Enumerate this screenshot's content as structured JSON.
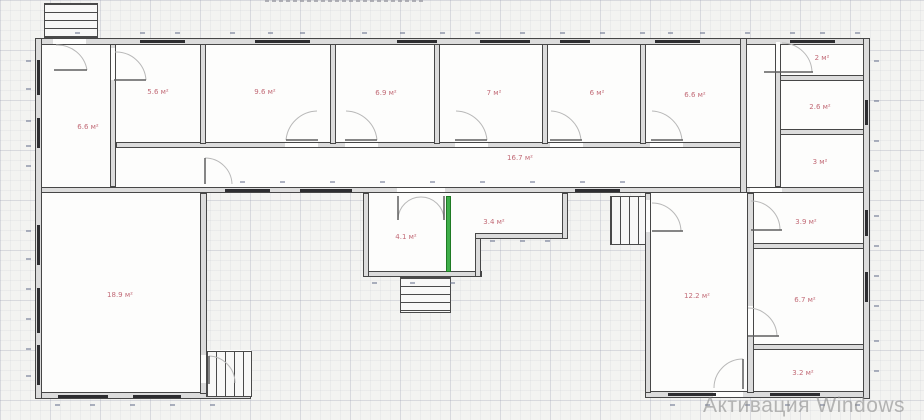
{
  "app": {
    "watermark": "Активация Windows"
  },
  "plan": {
    "unit_suffix": "м²",
    "colors": {
      "area_label": "#c26b77",
      "highlight_wall": "#3fae4a",
      "wall_fill": "#dcdcdc",
      "wall_outline": "#474747",
      "window_segment": "#2d2d30",
      "watermark_gray": "#8c8c8c"
    },
    "rooms": [
      {
        "name": "room-top-left",
        "area": "6.6 м²"
      },
      {
        "name": "room-top-1",
        "area": "5.6 м²"
      },
      {
        "name": "room-top-2",
        "area": "9.6 м²"
      },
      {
        "name": "room-top-3",
        "area": "6.9 м²"
      },
      {
        "name": "room-top-4",
        "area": "7 м²"
      },
      {
        "name": "room-top-5",
        "area": "6 м²"
      },
      {
        "name": "room-top-6",
        "area": "6.6 м²"
      },
      {
        "name": "room-right-top",
        "area": "2 м²"
      },
      {
        "name": "room-right-2",
        "area": "2.6 м²"
      },
      {
        "name": "room-right-3",
        "area": "3 м²"
      },
      {
        "name": "corridor",
        "area": "16.7 м²"
      },
      {
        "name": "room-large-left",
        "area": "18.9 м²"
      },
      {
        "name": "room-mid-1",
        "area": "4.1 м²"
      },
      {
        "name": "room-mid-2",
        "area": "3.4 м²"
      },
      {
        "name": "room-right-large",
        "area": "12.2 м²"
      },
      {
        "name": "room-right-4",
        "area": "3.9 м²"
      },
      {
        "name": "room-right-5",
        "area": "6.7 м²"
      },
      {
        "name": "room-right-6",
        "area": "3.2 м²"
      }
    ]
  }
}
